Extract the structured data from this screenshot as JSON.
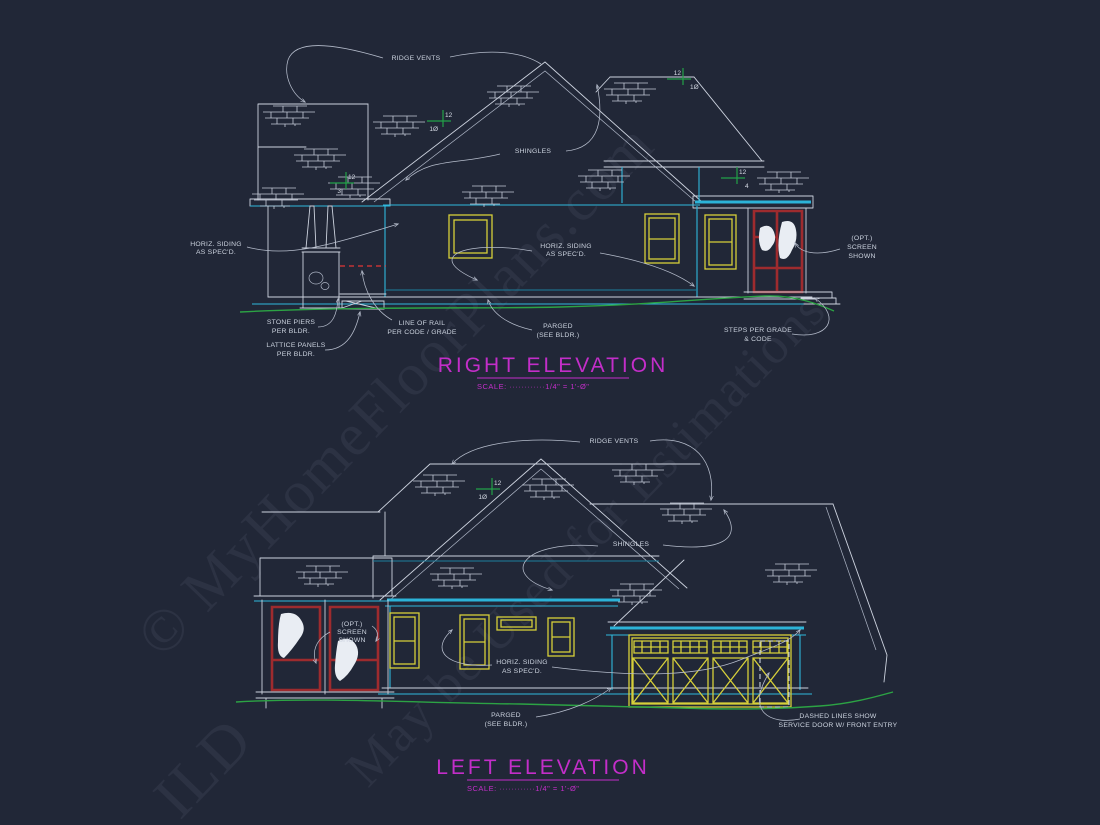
{
  "drawing": {
    "type": "architectural elevation blueprint",
    "background": "#212737",
    "colors": {
      "line_white": "#cdd3df",
      "cyan_trim": "#30b8dc",
      "teal": "#1d7f9c",
      "window_yellow": "#d6cf3a",
      "screen_red": "#9e2b2e",
      "rail_red_dashed": "#e23636",
      "grade_green": "#2ca344",
      "pitch_green": "#22a148",
      "title_magenta": "#c32ec9",
      "curtain_white": "#e9edf3"
    },
    "watermark": {
      "line1": "© MyHomeFloorPlans.com",
      "line2": "May be Used for Estimations",
      "line3": "ILD"
    },
    "right_elevation": {
      "title": "RIGHT ELEVATION",
      "scale": "SCALE: ············1/4\" = 1'-Ø\"",
      "labels": {
        "ridge_vents": "RIDGE VENTS",
        "shingles": "SHINGLES",
        "horiz_siding_left": [
          "HORIZ. SIDING",
          "AS SPEC'D."
        ],
        "horiz_siding_center": [
          "HORIZ. SIDING",
          "AS SPEC'D."
        ],
        "opt_screen": [
          "(OPT.)",
          "SCREEN",
          "SHOWN"
        ],
        "stone_piers": [
          "STONE PIERS",
          "PER BLDR."
        ],
        "lattice_panels": [
          "LATTICE PANELS",
          "PER BLDR."
        ],
        "line_of_rail": [
          "LINE OF RAIL",
          "PER CODE / GRADE"
        ],
        "parged": [
          "PARGED",
          "(SEE BLDR.)"
        ],
        "steps": [
          "STEPS PER GRADE",
          "& CODE"
        ]
      },
      "pitch_markers": [
        {
          "rise": "12",
          "run": "1Ø"
        },
        {
          "rise": "12",
          "run": "3"
        },
        {
          "rise": "12",
          "run": "1Ø"
        },
        {
          "rise": "12",
          "run": "4"
        }
      ]
    },
    "left_elevation": {
      "title": "LEFT ELEVATION",
      "scale": "SCALE: ············1/4\" = 1'-Ø\"",
      "labels": {
        "ridge_vents": "RIDGE VENTS",
        "shingles": "SHINGLES",
        "opt_screen": [
          "(OPT.)",
          "SCREEN",
          "SHOWN"
        ],
        "horiz_siding": [
          "HORIZ. SIDING",
          "AS SPEC'D."
        ],
        "parged": [
          "PARGED",
          "(SEE BLDR.)"
        ],
        "dashed_lines": [
          "DASHED LINES SHOW",
          "SERVICE DOOR W/ FRONT ENTRY"
        ]
      },
      "pitch_markers": [
        {
          "rise": "12",
          "run": "1Ø"
        }
      ]
    }
  }
}
